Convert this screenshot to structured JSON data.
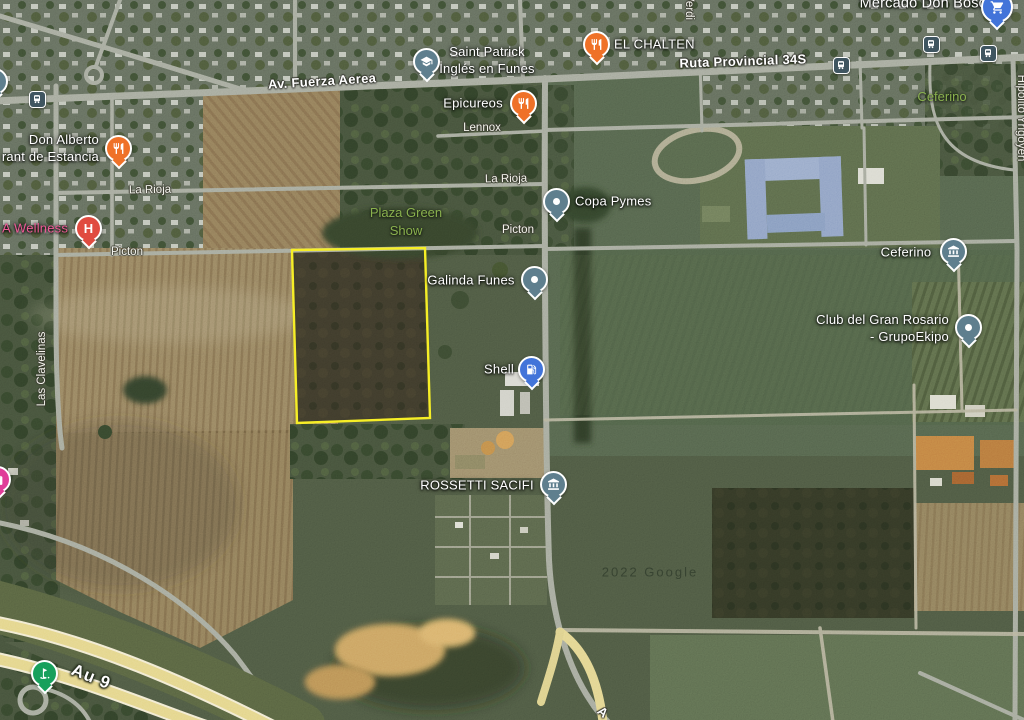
{
  "labels": {
    "mercado": "Mercado Don Bosco",
    "saint_patrick_1": "Saint Patrick",
    "saint_patrick_2": "Inglés en Funes",
    "el_chalten": "EL CHALTEN",
    "ruta": "Ruta Provincial 34S",
    "verdi": "Verdi",
    "av_fuerza": "Av. Fuerza Aerea",
    "epicureos": "Epicureos",
    "lennox": "Lennox",
    "ceferino_park": "Ceferino",
    "don_alberto_1": "Don Alberto",
    "don_alberto_2": "rant de Estancia",
    "la_rioja_w": "La Rioja",
    "la_rioja_e": "La Rioja",
    "a_wellness": "A Wellness",
    "picton_w": "Picton",
    "picton_e": "Picton",
    "copa_pymes": "Copa Pymes",
    "plaza_green_1": "Plaza Green",
    "plaza_green_2": "Show",
    "galinda": "Galinda Funes",
    "las_clavelinas": "Las Clavelinas",
    "ceferino_poi": "Ceferino",
    "club_1": "Club del Gran Rosario",
    "club_2": "- GrupoEkipo",
    "shell": "Shell",
    "rossetti": "ROSSETTI SACIFI",
    "hipolito": "Hipólito Yrigoyen",
    "au9": "Au 9",
    "a_partial": "A",
    "watermark": "2022 Google"
  },
  "icons": {
    "hospital": "H",
    "restaurant": "fork-and-knife",
    "school": "graduation-cap",
    "gas_station": "fuel-pump",
    "transit": "bus",
    "landmark": "building-columns",
    "generic_poi": "dot",
    "golf": "golf-flag",
    "shopping": "shopping-bag",
    "grocery": "shopping-cart"
  },
  "colors": {
    "parcel_outline": "#f6ee26",
    "restaurant_pin": "#ef7128",
    "generic_pin": "#5f7f8e",
    "hospital_pin": "#e04b40",
    "gas_pin": "#4274d9",
    "golf_pin": "#17a05c",
    "transit_icon": "#3f5560",
    "shopping_pin_pink": "#e03c98",
    "shopping_pin_blue": "#4274d9",
    "park_label": "#8ab14e",
    "health_label": "#ee5a96"
  }
}
